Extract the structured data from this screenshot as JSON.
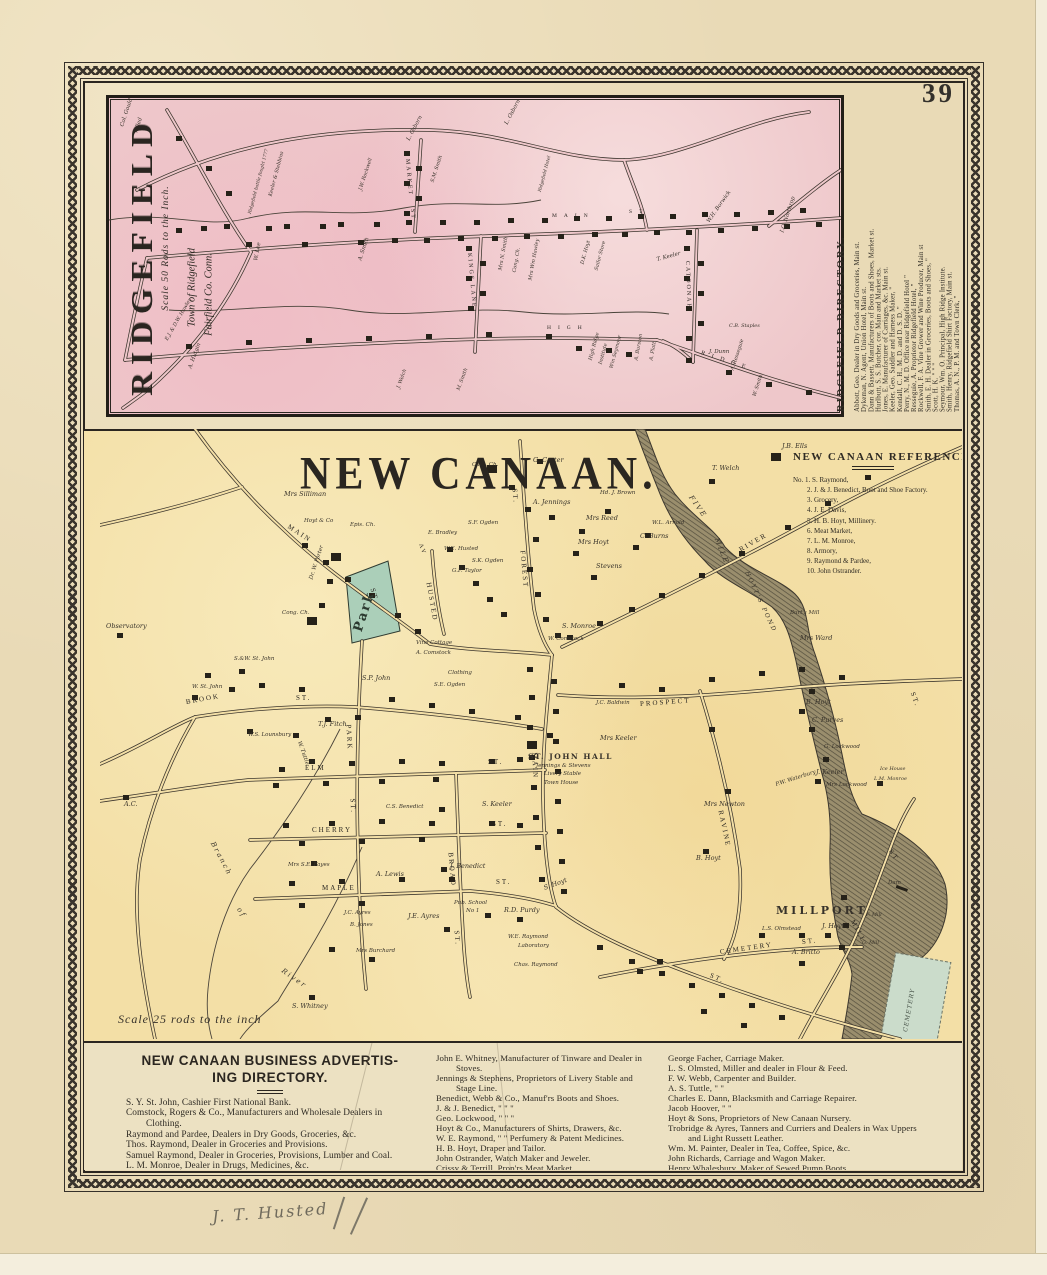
{
  "page": {
    "number": "39",
    "inscription": "J. T. Husted",
    "colors": {
      "paper": "#e9dab6",
      "ridgefield_pink": "#eec7ca",
      "newcanaan_yellow": "#f3dfa6",
      "park_green": "#abcfb9",
      "cemetery_green": "#cbdccb",
      "ink": "#2e2a23"
    }
  },
  "ridgefield": {
    "title": "RIDGEFIELD",
    "scale": "Scale 50 Rods to the Inch.",
    "town1": "Town of Ridgefield",
    "town2": "Fairfield Co. Conn.",
    "labels": [
      {
        "t": "MAIN",
        "x": 443,
        "y": 116,
        "c": "stw"
      },
      {
        "t": "ST",
        "x": 520,
        "y": 112,
        "c": "stw"
      },
      {
        "t": "KINGS LANE",
        "x": 360,
        "y": 152,
        "r": 85,
        "c": "st",
        "s": 6
      },
      {
        "t": "CATOONAH",
        "x": 578,
        "y": 160,
        "r": 88,
        "c": "st",
        "s": 6
      },
      {
        "t": "MARKET",
        "x": 298,
        "y": 58,
        "r": 85,
        "c": "st",
        "s": 6
      },
      {
        "t": "ST",
        "x": 303,
        "y": 108,
        "r": 85,
        "c": "st",
        "s": 6
      },
      {
        "t": "HIGH",
        "x": 438,
        "y": 228,
        "c": "stw"
      },
      {
        "t": "RIDGE",
        "x": 592,
        "y": 252,
        "r": 18,
        "c": "stw",
        "s": 6
      },
      {
        "t": "Col. Gould",
        "x": 14,
        "y": 26,
        "r": -72
      },
      {
        "t": "killed",
        "x": 28,
        "y": 32,
        "r": -72
      },
      {
        "t": "L. Osborn",
        "x": 300,
        "y": 40,
        "r": -62
      },
      {
        "t": "L. Osborn",
        "x": 398,
        "y": 24,
        "r": -62
      },
      {
        "t": "T. Keeler",
        "x": 548,
        "y": 160,
        "r": -15
      },
      {
        "t": "W.H. Borwick",
        "x": 600,
        "y": 122,
        "r": -55
      },
      {
        "t": "I.O. Northrop",
        "x": 674,
        "y": 132,
        "r": -72
      },
      {
        "t": "Keeler & Stebbins",
        "x": 162,
        "y": 96,
        "r": -75,
        "s": 5
      },
      {
        "t": "Ridgefield battle fought 1777",
        "x": 142,
        "y": 114,
        "r": -75,
        "s": 4.5
      },
      {
        "t": "W. Lee",
        "x": 148,
        "y": 160,
        "r": -80
      },
      {
        "t": "A. Smith",
        "x": 252,
        "y": 160,
        "r": -72
      },
      {
        "t": "J.W. Rockwell",
        "x": 252,
        "y": 90,
        "r": -72,
        "s": 5
      },
      {
        "t": "S.M. Smith",
        "x": 324,
        "y": 82,
        "r": -72,
        "s": 5
      },
      {
        "t": "Cong. Ch.",
        "x": 406,
        "y": 172,
        "r": -80,
        "s": 5
      },
      {
        "t": "Mrs N. Smith",
        "x": 392,
        "y": 170,
        "r": -80,
        "s": 5
      },
      {
        "t": "Mrs Wm Hawley",
        "x": 422,
        "y": 180,
        "r": -80,
        "s": 5
      },
      {
        "t": "D.K. Hoyt",
        "x": 474,
        "y": 164,
        "r": -75,
        "s": 5
      },
      {
        "t": "Sailor Store",
        "x": 488,
        "y": 170,
        "r": -75,
        "s": 5
      },
      {
        "t": "Ridgefield Hotel",
        "x": 432,
        "y": 92,
        "r": -75,
        "s": 4.5
      },
      {
        "t": "High Ridge",
        "x": 482,
        "y": 260,
        "r": -75,
        "s": 5
      },
      {
        "t": "Institute",
        "x": 492,
        "y": 264,
        "r": -75,
        "s": 5
      },
      {
        "t": "Wm Seymour",
        "x": 503,
        "y": 268,
        "r": -75,
        "s": 5
      },
      {
        "t": "A. Burston",
        "x": 528,
        "y": 260,
        "r": -80,
        "s": 5
      },
      {
        "t": "A. Platt",
        "x": 543,
        "y": 260,
        "r": -80,
        "s": 5
      },
      {
        "t": "A. Resseguie",
        "x": 624,
        "y": 270,
        "r": -72,
        "s": 5
      },
      {
        "t": "W. Smith",
        "x": 646,
        "y": 296,
        "r": -72,
        "s": 5
      },
      {
        "t": "J. Dunn",
        "x": 600,
        "y": 252
      },
      {
        "t": "C.B. Staples",
        "x": 620,
        "y": 226,
        "s": 5
      },
      {
        "t": "A. Hutgin",
        "x": 82,
        "y": 268,
        "r": -70
      },
      {
        "t": "J. Welch",
        "x": 290,
        "y": 288,
        "r": -70,
        "s": 5
      },
      {
        "t": "M. Smith",
        "x": 350,
        "y": 290,
        "r": -70,
        "s": 5
      },
      {
        "t": "E.J. & D.W. Hawley",
        "x": 58,
        "y": 240,
        "r": -60,
        "s": 5
      }
    ]
  },
  "ridgefield_directory": {
    "title": "RIDGEFIELD DIRECTORY.",
    "entries": [
      "Abbott, Geo. Dealer in Dry Goods and Groceries, Main st.",
      "Dykeman, N. Agent, Union Hotel, Main st.",
      "Dann & Bassett, Manufacturers of Boots and Shoes, Market st.",
      "Hurlbutt, S. S. Butcher, cor. Main and Market sts.",
      "Jones, E. Manufacturer of Carriages, &c. Main st.",
      "Keeler, Geo. Saddler and Harness Maker,  \"",
      "Kendall, C. H., M. D. and D. S. D.  \"",
      "Perry, N., M. D. Office near Ridgefield Hotel  \"",
      "Resseguie, A. Proprietor Ridgefield Hotel,  \"",
      "Rockwell, F. A. Vine Grower and Wine Producer, Main st",
      "Smith, E. H. Dealer in Groceries, Boots and Shoes,  \"",
      "Scott, H. K.  \"  \"  \"",
      "Seymour, Wm. O. Principal, High Ridge Institute.",
      "Smith, Henry, Ridgefield Shirt Factory, Main st.",
      "Thomas, A. N., P. M. and Town Clerk,  \""
    ]
  },
  "newcanaan": {
    "title": "NEW CANAAN.",
    "scale": "Scale 25 rods to the inch",
    "labels": [
      {
        "t": "MAIN",
        "x": 188,
        "y": 94,
        "r": 33,
        "c": "st"
      },
      {
        "t": "ST.",
        "x": 272,
        "y": 156,
        "r": 75,
        "c": "st"
      },
      {
        "t": "BROOK",
        "x": 86,
        "y": 270,
        "r": -10,
        "c": "st"
      },
      {
        "t": "ST.",
        "x": 196,
        "y": 266,
        "c": "st"
      },
      {
        "t": "ELM",
        "x": 205,
        "y": 336,
        "c": "st"
      },
      {
        "t": "ST.",
        "x": 388,
        "y": 330,
        "c": "st"
      },
      {
        "t": "CHERRY",
        "x": 212,
        "y": 398,
        "c": "st"
      },
      {
        "t": "ST.",
        "x": 392,
        "y": 392,
        "c": "st"
      },
      {
        "t": "MAPLE",
        "x": 222,
        "y": 456,
        "c": "st"
      },
      {
        "t": "ST.",
        "x": 396,
        "y": 450,
        "c": "st"
      },
      {
        "t": "PARK",
        "x": 248,
        "y": 292,
        "r": 87,
        "c": "st"
      },
      {
        "t": "ST.",
        "x": 252,
        "y": 366,
        "r": 87,
        "c": "st"
      },
      {
        "t": "BROAD",
        "x": 350,
        "y": 420,
        "r": 85,
        "c": "st"
      },
      {
        "t": "ST.",
        "x": 356,
        "y": 498,
        "r": 85,
        "c": "st"
      },
      {
        "t": "MAIN",
        "x": 434,
        "y": 320,
        "r": 88,
        "c": "st"
      },
      {
        "t": "ST.",
        "x": 610,
        "y": 543,
        "r": 24,
        "c": "st"
      },
      {
        "t": "HUSTED",
        "x": 328,
        "y": 150,
        "r": 80,
        "c": "st"
      },
      {
        "t": "AV",
        "x": 320,
        "y": 112,
        "r": 70,
        "c": "st",
        "s": 6
      },
      {
        "t": "FOREST",
        "x": 422,
        "y": 118,
        "r": 85,
        "c": "st"
      },
      {
        "t": "ST.",
        "x": 414,
        "y": 56,
        "r": 85,
        "c": "st"
      },
      {
        "t": "RIVER",
        "x": 640,
        "y": 118,
        "r": -30,
        "c": "st"
      },
      {
        "t": "PROSPECT",
        "x": 540,
        "y": 272,
        "r": -4,
        "c": "st"
      },
      {
        "t": "ST.",
        "x": 812,
        "y": 260,
        "r": 70,
        "c": "st"
      },
      {
        "t": "RAVINE",
        "x": 620,
        "y": 378,
        "r": 78,
        "c": "st"
      },
      {
        "t": "CEMETERY",
        "x": 620,
        "y": 520,
        "r": -8,
        "c": "st"
      },
      {
        "t": "ST.",
        "x": 702,
        "y": 510,
        "r": -6,
        "c": "st"
      },
      {
        "t": "MILL",
        "x": 752,
        "y": 488,
        "r": 62,
        "c": "st"
      },
      {
        "t": "ST",
        "x": 790,
        "y": 418,
        "r": 55,
        "c": "st"
      },
      {
        "t": "MILLPORT",
        "x": 676,
        "y": 476,
        "c": "place"
      },
      {
        "t": "FIVE",
        "x": 590,
        "y": 64,
        "r": 55,
        "c": "water"
      },
      {
        "t": "MILE",
        "x": 616,
        "y": 106,
        "r": 68,
        "c": "water"
      },
      {
        "t": "HOYT'S POND",
        "x": 646,
        "y": 140,
        "r": 65,
        "c": "water",
        "s": 6
      },
      {
        "t": "Branch",
        "x": 112,
        "y": 410,
        "r": 62,
        "c": "water"
      },
      {
        "t": "of",
        "x": 138,
        "y": 476,
        "r": 55,
        "c": "water"
      },
      {
        "t": "River",
        "x": 182,
        "y": 538,
        "r": 35,
        "c": "water"
      },
      {
        "t": "Dam",
        "x": 788,
        "y": 452,
        "s": 5.5
      },
      {
        "t": "Park",
        "x": 258,
        "y": 196,
        "r": -72,
        "c": "park"
      },
      {
        "t": "CEMETERY",
        "x": 806,
        "y": 600,
        "r": -80,
        "c": "cem"
      },
      {
        "t": "Mrs Silliman",
        "x": 184,
        "y": 62
      },
      {
        "t": "Cath. Ch.",
        "x": 372,
        "y": 34,
        "s": 5.5
      },
      {
        "t": "G. Carter",
        "x": 433,
        "y": 28
      },
      {
        "t": "J.B. Ells",
        "x": 682,
        "y": 14
      },
      {
        "t": "T. Welch",
        "x": 612,
        "y": 36
      },
      {
        "t": "A. Jennings",
        "x": 433,
        "y": 70
      },
      {
        "t": "Mrs Reed",
        "x": 486,
        "y": 86
      },
      {
        "t": "Mrs Hoyt",
        "x": 478,
        "y": 110
      },
      {
        "t": "Hd. J. Brown",
        "x": 500,
        "y": 62,
        "s": 5.5
      },
      {
        "t": "W.L. Arnold",
        "x": 552,
        "y": 92,
        "s": 5.5
      },
      {
        "t": "C. Burns",
        "x": 540,
        "y": 104
      },
      {
        "t": "Stevens",
        "x": 496,
        "y": 134
      },
      {
        "t": "Burt's Mill",
        "x": 690,
        "y": 182,
        "s": 5.5
      },
      {
        "t": "Mrs Ward",
        "x": 700,
        "y": 206
      },
      {
        "t": "Hoyt & Co",
        "x": 204,
        "y": 90,
        "s": 5.5
      },
      {
        "t": "Epis. Ch.",
        "x": 250,
        "y": 94,
        "s": 5.5
      },
      {
        "t": "Dr. W. Porter",
        "x": 212,
        "y": 148,
        "r": -72,
        "s": 5.5
      },
      {
        "t": "Cong. Ch.",
        "x": 182,
        "y": 182,
        "s": 5.5
      },
      {
        "t": "Observatory",
        "x": 6,
        "y": 194
      },
      {
        "t": "S.&W. St. John",
        "x": 134,
        "y": 228,
        "s": 5.5
      },
      {
        "t": "W. St. John",
        "x": 92,
        "y": 256,
        "s": 5.5
      },
      {
        "t": "S.P. John",
        "x": 262,
        "y": 246
      },
      {
        "t": "T.J. Fitch",
        "x": 218,
        "y": 292
      },
      {
        "t": "W.S. Lounsbury",
        "x": 148,
        "y": 304,
        "s": 5.5
      },
      {
        "t": "W. Tuttle",
        "x": 198,
        "y": 310,
        "r": 70,
        "s": 5.5
      },
      {
        "t": "A.C.",
        "x": 24,
        "y": 372
      },
      {
        "t": "Mrs S.E. Fayes",
        "x": 188,
        "y": 434,
        "s": 5.5
      },
      {
        "t": "S. Whitney",
        "x": 192,
        "y": 574
      },
      {
        "t": "Vine Cottage",
        "x": 316,
        "y": 212,
        "s": 5.5
      },
      {
        "t": "A. Comstock",
        "x": 316,
        "y": 222,
        "s": 5.5
      },
      {
        "t": "Clothing",
        "x": 348,
        "y": 242,
        "s": 5.5
      },
      {
        "t": "S.E. Ogden",
        "x": 334,
        "y": 254,
        "s": 5.5
      },
      {
        "t": "E. Bradley",
        "x": 328,
        "y": 102,
        "s": 5.5
      },
      {
        "t": "S.F. Ogden",
        "x": 368,
        "y": 92,
        "s": 5.5
      },
      {
        "t": "S.K. Ogden",
        "x": 372,
        "y": 130,
        "s": 5.5
      },
      {
        "t": "W.E. Husted",
        "x": 344,
        "y": 118,
        "s": 5.5
      },
      {
        "t": "G.F. Taylor",
        "x": 352,
        "y": 140,
        "s": 5.5
      },
      {
        "t": "W. Comstock",
        "x": 448,
        "y": 208,
        "s": 5.5
      },
      {
        "t": "S. Monroe",
        "x": 462,
        "y": 194
      },
      {
        "t": "J. Benedict",
        "x": 350,
        "y": 434
      },
      {
        "t": "S. Keeler",
        "x": 382,
        "y": 372
      },
      {
        "t": "C.S. Benedict",
        "x": 286,
        "y": 376,
        "s": 5.5
      },
      {
        "t": "A. Lewis",
        "x": 276,
        "y": 442
      },
      {
        "t": "J.E. Ayres",
        "x": 308,
        "y": 484
      },
      {
        "t": "J.C. Ayres",
        "x": 244,
        "y": 482,
        "s": 5.5
      },
      {
        "t": "B. Jones",
        "x": 250,
        "y": 494,
        "s": 5.5
      },
      {
        "t": "Mrs Burchard",
        "x": 256,
        "y": 520,
        "s": 5.5
      },
      {
        "t": "Pub. School",
        "x": 354,
        "y": 472,
        "s": 5.5
      },
      {
        "t": "No 1",
        "x": 366,
        "y": 480,
        "s": 5.5
      },
      {
        "t": "R.D. Purdy",
        "x": 404,
        "y": 478
      },
      {
        "t": "W.E. Raymond",
        "x": 408,
        "y": 506,
        "s": 5.5
      },
      {
        "t": "Laboratory",
        "x": 418,
        "y": 515,
        "s": 5.5
      },
      {
        "t": "Chas. Raymond",
        "x": 414,
        "y": 534,
        "s": 5.5
      },
      {
        "t": "S. Hoyt",
        "x": 444,
        "y": 456,
        "r": -20
      },
      {
        "t": "ST. JOHN HALL",
        "x": 428,
        "y": 324,
        "c": "sjh"
      },
      {
        "t": "Jennings & Stevens",
        "x": 436,
        "y": 335,
        "s": 5.5
      },
      {
        "t": "Livery Stable",
        "x": 444,
        "y": 343,
        "s": 5.5
      },
      {
        "t": "Town House",
        "x": 444,
        "y": 352,
        "s": 5.5
      },
      {
        "t": "J.C. Baldwin",
        "x": 496,
        "y": 272,
        "s": 5.5
      },
      {
        "t": "Mrs Keeler",
        "x": 500,
        "y": 306
      },
      {
        "t": "B. Hoyt",
        "x": 706,
        "y": 270
      },
      {
        "t": "C. Purves",
        "x": 712,
        "y": 288
      },
      {
        "t": "G. Lockwood",
        "x": 724,
        "y": 316,
        "s": 5.5
      },
      {
        "t": "J. Keeler",
        "x": 716,
        "y": 340
      },
      {
        "t": "Mrs Lockwood",
        "x": 726,
        "y": 354,
        "s": 5.5
      },
      {
        "t": "Mrs Newton",
        "x": 604,
        "y": 372
      },
      {
        "t": "P.W. Waterbury",
        "x": 676,
        "y": 354,
        "r": -18,
        "s": 5.5
      },
      {
        "t": "B. Hoyt",
        "x": 596,
        "y": 426
      },
      {
        "t": "Ice House",
        "x": 780,
        "y": 338,
        "s": 5
      },
      {
        "t": "L.M. Monroe",
        "x": 774,
        "y": 348,
        "s": 5
      },
      {
        "t": "L.S. Olmstead",
        "x": 662,
        "y": 498,
        "s": 5.5
      },
      {
        "t": "J. Hoyt",
        "x": 722,
        "y": 494
      },
      {
        "t": "A. Britto",
        "x": 692,
        "y": 520
      },
      {
        "t": "F. Mill",
        "x": 766,
        "y": 484,
        "s": 5
      },
      {
        "t": "G. Mill",
        "x": 762,
        "y": 512,
        "s": 5
      }
    ]
  },
  "newcanaan_references": {
    "title": "NEW CANAAN REFERENCES.",
    "items": [
      "No. 1.  S. Raymond,",
      "2.  J. & J. Benedict, Boot and Shoe Factory.",
      "3.  Grocery,",
      "4.  J. E. Davis,",
      "5.  H. B. Hoyt, Millinery.",
      "6.  Meat Market,",
      "7.  L. M. Monroe,",
      "8.  Armory,",
      "9.  Raymond & Pardee,",
      "10. John Ostrander."
    ]
  },
  "business_directory": {
    "title_line1": "NEW CANAAN BUSINESS ADVERTIS-",
    "title_line2": "ING DIRECTORY.",
    "col1": [
      "S. Y. St. John, Cashier First National Bank.",
      "Comstock, Rogers & Co., Manufacturers and Wholesale Dealers in Clothing.",
      "Raymond and Pardee, Dealers in Dry Goods, Groceries, &c.",
      "Thos. Raymond, Dealer in Groceries and Provisions.",
      "Samuel Raymond, Dealer in Groceries, Provisions, Lumber and Coal.",
      "L. M. Monroe, Dealer in Drugs, Medicines, &c.",
      "Russell L. Hall, Manufacturer of and Dealer in Furniture, and Undertaker."
    ],
    "col2": [
      "John E. Whitney, Manufacturer of Tinware and Dealer in Stoves.",
      "Jennings & Stephens, Proprietors of Livery Stable and Stage Line.",
      "Benedict, Webb & Co., Manuf'rs Boots and Shoes.",
      "J. & J. Benedict,   \"   \"   \"",
      "Geo. Lockwood,   \"   \"   \"",
      "Hoyt & Co., Manufacturers of Shirts, Drawers, &c.",
      "W. E. Raymond,  \"  \"  Perfumery & Patent Medicines.",
      "H. B. Hoyt, Draper and Tailor.",
      "John Ostrander, Watch Maker and Jeweler.",
      "Crissy & Terrill, Prop'rs Meat Market.",
      "Rev. J. L. Gilder, Principal Church Hill Institute."
    ],
    "col3": [
      "George Facher, Carriage Maker.",
      "L. S. Olmsted, Miller and dealer in Flour & Feed.",
      "F. W. Webb, Carpenter and Builder.",
      "A. S. Tuttle,   \"   \"",
      "Charles E. Dann, Blacksmith and Carriage Repairer.",
      "Jacob Hoover,   \"   \"",
      "Hoyt & Sons, Proprietors of New Canaan Nursery.",
      "Trobridge & Ayres, Tanners and Curriers and Dealers in Wax Uppers and Light Russett Leather.",
      "Wm. M. Painter, Dealer in Tea, Coffee, Spice, &c.",
      "John Richards, Carriage and Wagon Maker.",
      "Henry Whalesbury, Maker of Sewed Pump Boots."
    ]
  }
}
